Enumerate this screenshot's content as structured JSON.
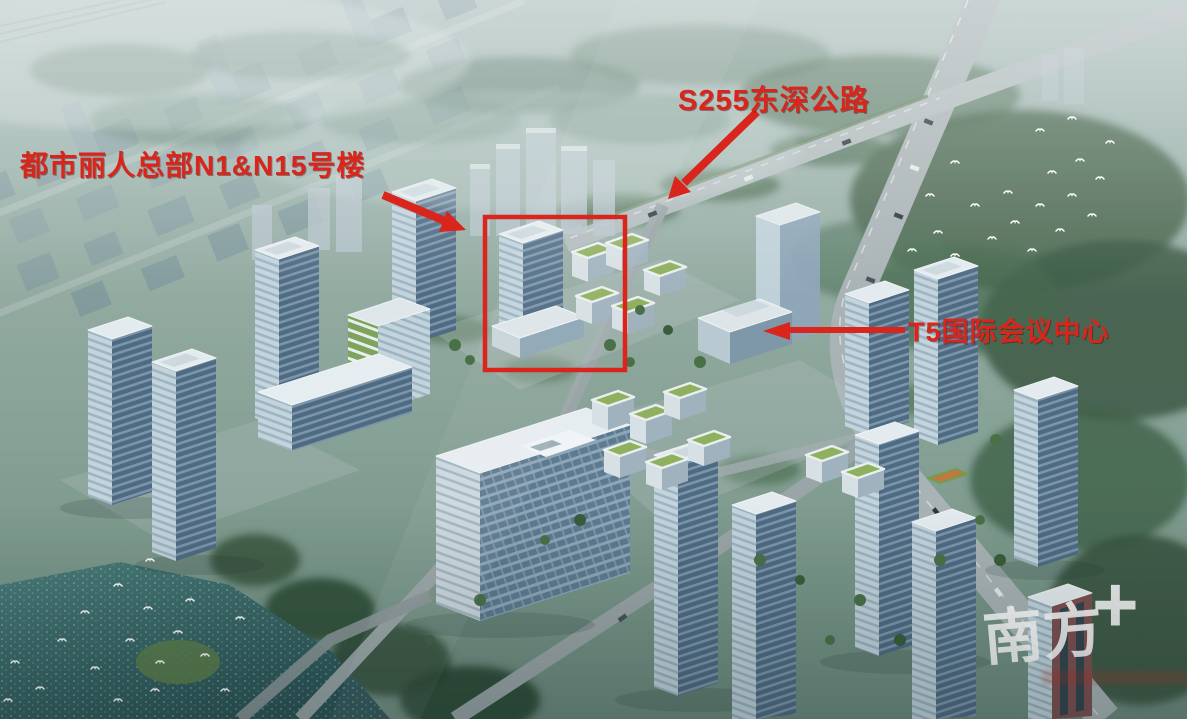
{
  "annotations": {
    "color": "#d9251b",
    "hq": {
      "label": "都市丽人总部N1&N15号楼"
    },
    "highway": {
      "label": "S255东深公路"
    },
    "conference": {
      "label": "T5国际会议中心"
    }
  },
  "watermark": {
    "brand": "南方",
    "plus_sign": "+"
  }
}
